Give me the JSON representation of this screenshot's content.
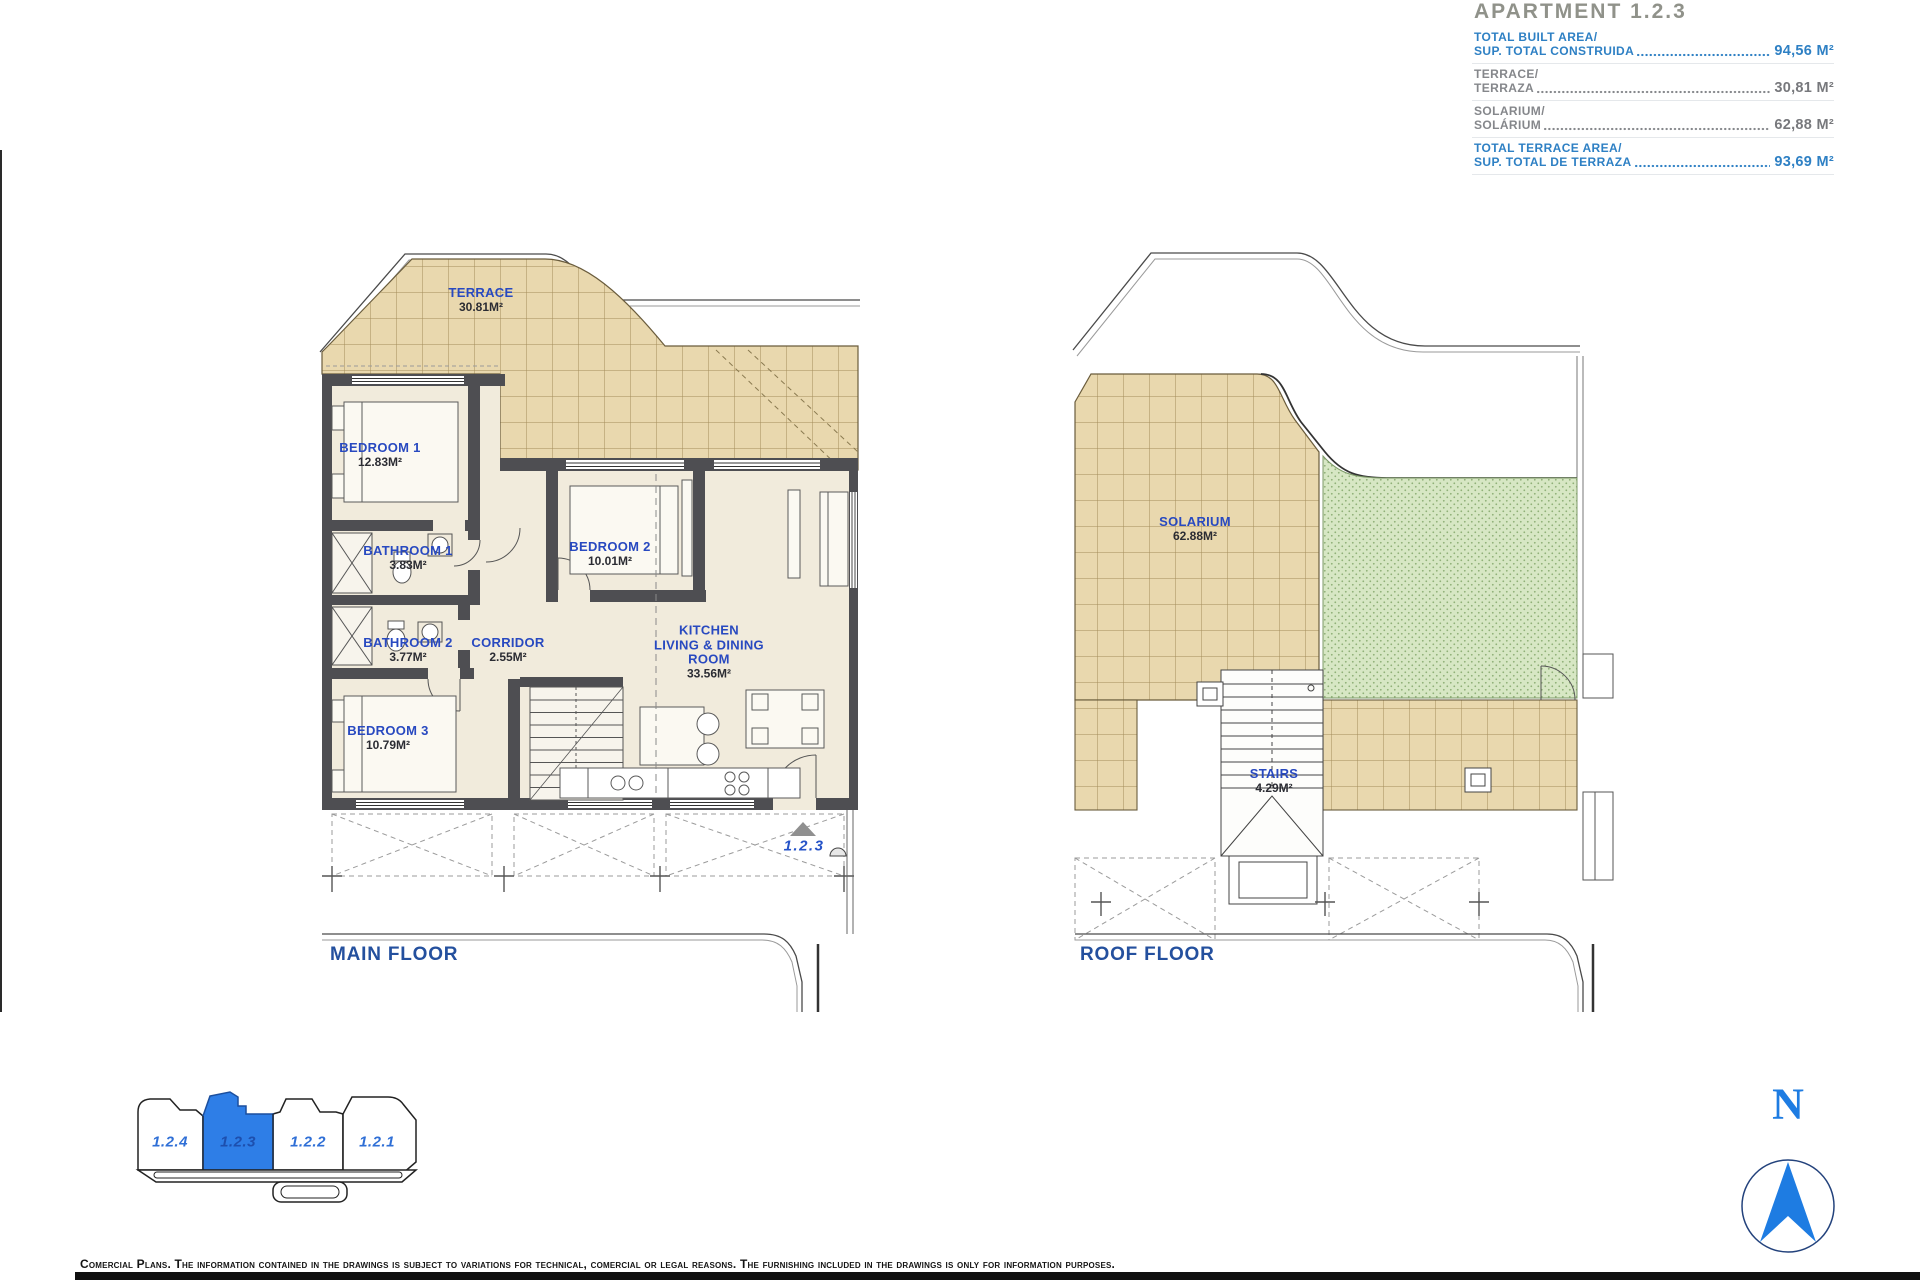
{
  "header": {
    "title": "APARTMENT 1.2.3",
    "rows": [
      {
        "line1": "TOTAL BUILT AREA/",
        "line2": "SUP. TOTAL CONSTRUIDA",
        "value": "94,56 M²"
      },
      {
        "line1": "TERRACE/",
        "line2": "TERRAZA",
        "value": "30,81 M²"
      },
      {
        "line1": "SOLARIUM/",
        "line2": "SOLÁRIUM",
        "value": "62,88 M²"
      },
      {
        "line1": "TOTAL TERRACE AREA/",
        "line2": "SUP. TOTAL DE TERRAZA",
        "value": "93,69 M²"
      }
    ]
  },
  "main_floor": {
    "caption": "MAIN FLOOR",
    "entrance_marker": "1.2.3",
    "rooms": {
      "terrace": {
        "name": "TERRACE",
        "area": "30.81M²"
      },
      "bedroom1": {
        "name": "BEDROOM 1",
        "area": "12.83M²"
      },
      "bathroom1": {
        "name": "BATHROOM 1",
        "area": "3.83M²"
      },
      "bathroom2": {
        "name": "BATHROOM 2",
        "area": "3.77M²"
      },
      "corridor": {
        "name": "CORRIDOR",
        "area": "2.55M²"
      },
      "bedroom2": {
        "name": "BEDROOM 2",
        "area": "10.01M²"
      },
      "bedroom3": {
        "name": "BEDROOM 3",
        "area": "10.79M²"
      },
      "kitchen": {
        "line1": "KITCHEN",
        "line2": "LIVING & DINING",
        "line3": "ROOM",
        "area": "33.56M²"
      }
    }
  },
  "roof_floor": {
    "caption": "ROOF FLOOR",
    "rooms": {
      "solarium": {
        "name": "SOLARIUM",
        "area": "62.88M²"
      },
      "stairs": {
        "name": "STAIRS",
        "area": "4.29M²"
      }
    }
  },
  "key_plan": {
    "units": [
      {
        "label": "1.2.4",
        "active": false
      },
      {
        "label": "1.2.3",
        "active": true
      },
      {
        "label": "1.2.2",
        "active": false
      },
      {
        "label": "1.2.1",
        "active": false
      }
    ]
  },
  "compass": {
    "north_label": "N"
  },
  "footer": {
    "disclaimer": "Comercial Plans. The information contained in the drawings is subject to variations for technical, comercial or legal reasons. The furnishing included in the drawings is only for information purposes."
  },
  "colors": {
    "accent_blue": "#2e80c4",
    "room_label_blue": "#2849c0",
    "highlight_blue": "#2e7ee7",
    "tile_tan": "#e9d8ae",
    "grass_green": "#d7e7c4"
  }
}
